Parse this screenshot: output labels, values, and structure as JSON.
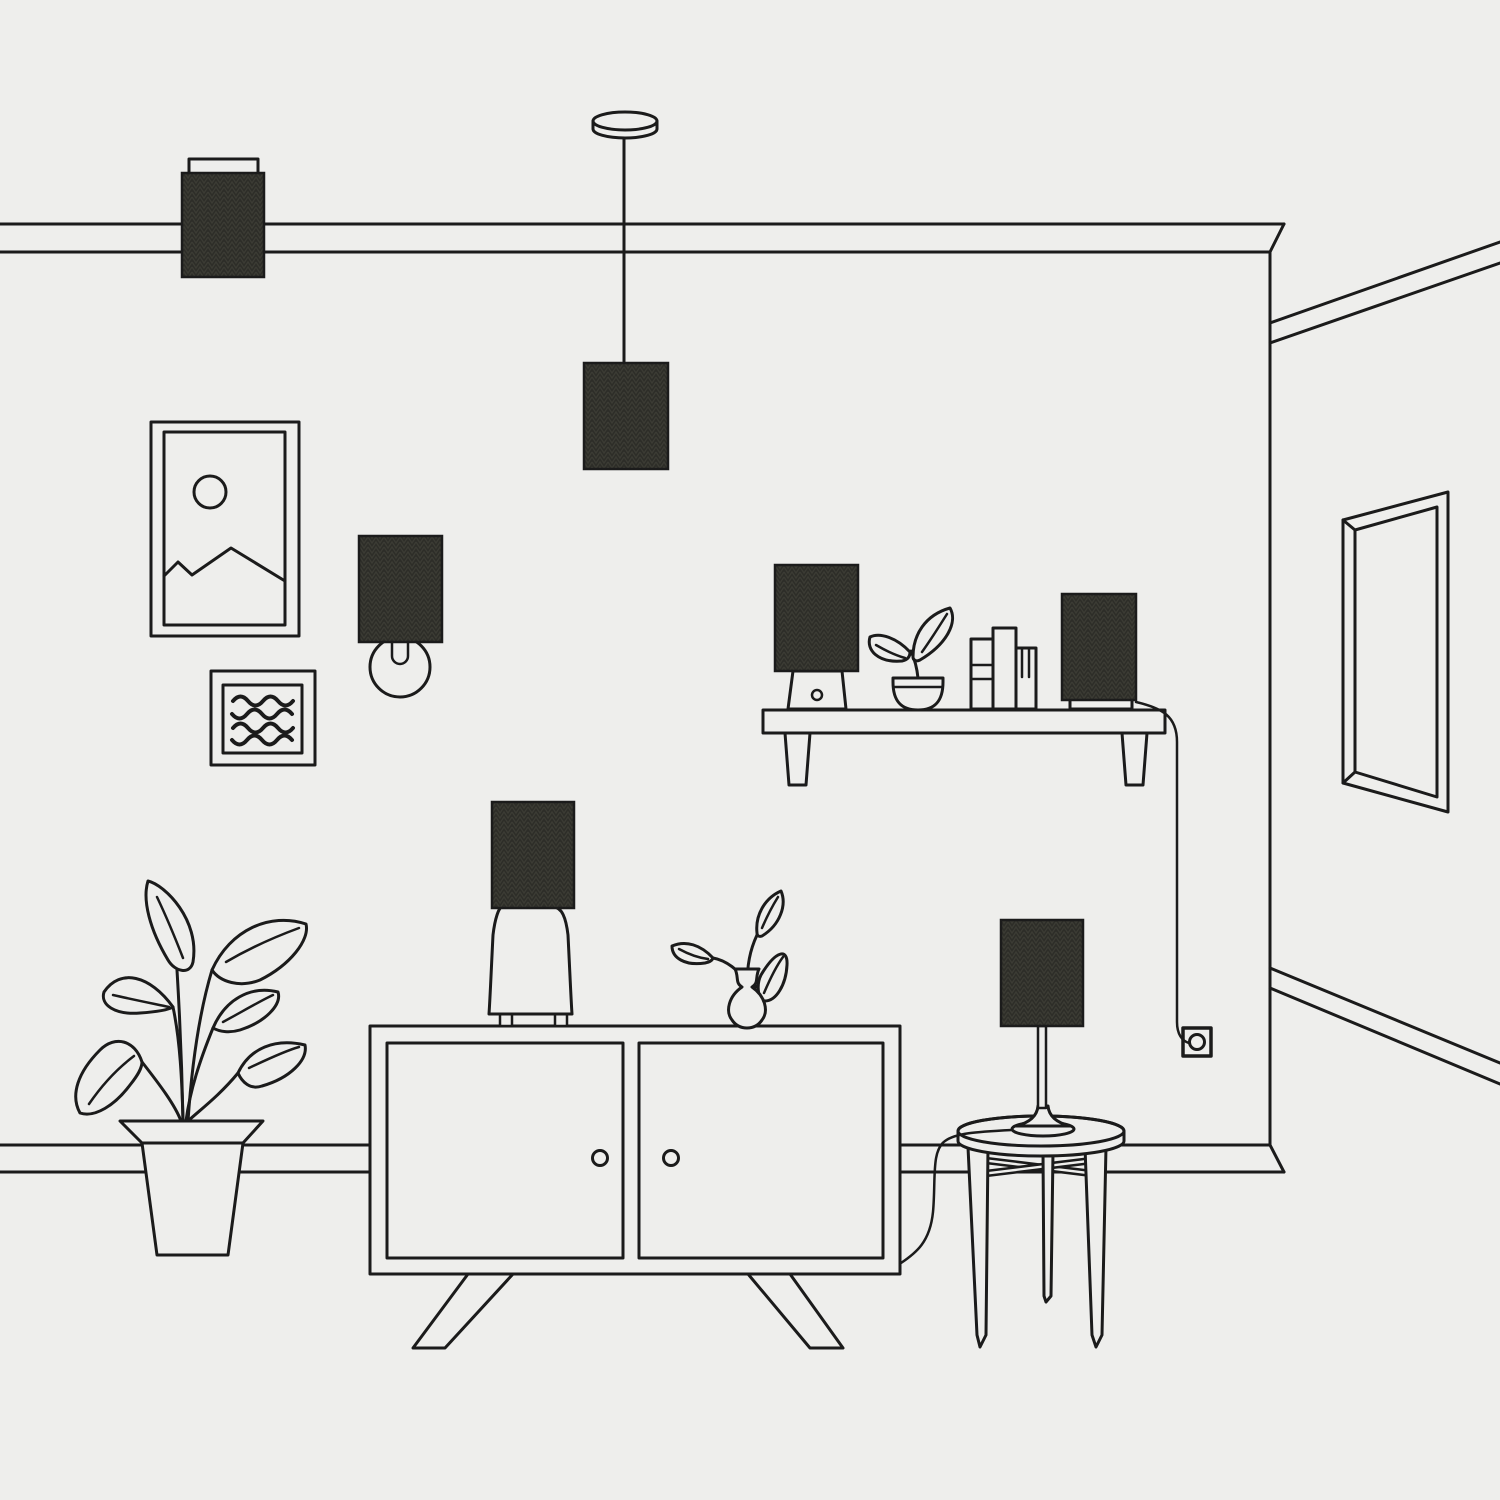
{
  "canvas": {
    "width": 1500,
    "height": 1500
  },
  "colors": {
    "background": "#eeeeec",
    "line": "#1b1b1b",
    "lampshade_base": "#2d2d28",
    "lampshade_zigzag": "#3c3c34"
  },
  "scene": {
    "description_labels": {
      "ceiling_molding": "ceiling-molding",
      "flush_ceiling_lamp": "flush-ceiling-lamp",
      "pendant_lamp": "pendant-lamp",
      "wall_art_frame": "wall-art-frame",
      "wall_sconce": "wall-sconce",
      "squiggle_frame": "squiggle-frame",
      "wall_shelf": "wall-shelf",
      "shelf_table_lamp": "shelf-table-lamp",
      "shelf_plant": "shelf-plant",
      "shelf_books": "shelf-books",
      "shelf_box_lamp": "shelf-box-lamp",
      "outlet_cord": "outlet-cord",
      "wall_outlet": "wall-outlet",
      "wall_mirror": "wall-mirror",
      "room_corner": "room-corner",
      "right_wall_molding": "right-wall-molding",
      "right_wall_baseboard": "right-wall-baseboard",
      "front_baseboard": "front-baseboard",
      "floor_plant": "floor-plant",
      "sideboard": "sideboard",
      "sideboard_lamp": "sideboard-lamp",
      "bud_vase": "bud-vase",
      "side_table": "side-table",
      "table_lamp": "table-lamp",
      "table_lamp_cord": "table-lamp-cord"
    }
  }
}
